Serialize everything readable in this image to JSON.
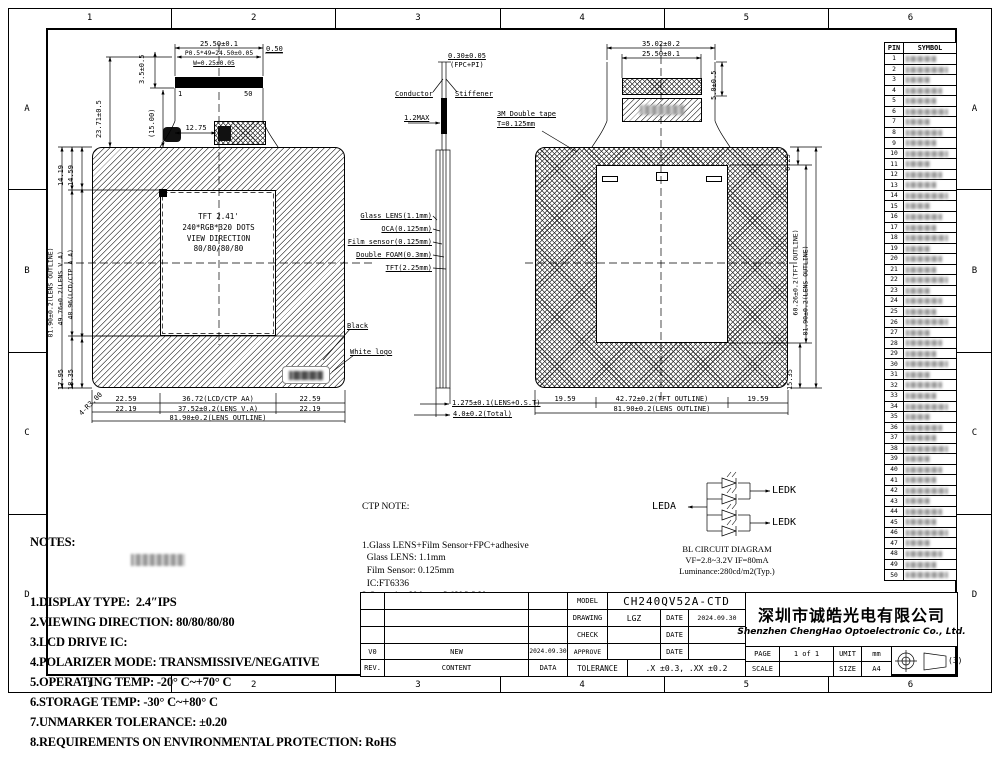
{
  "frame": {
    "cols": [
      "1",
      "2",
      "3",
      "4",
      "5",
      "6"
    ],
    "rows": [
      "A",
      "B",
      "C",
      "D"
    ]
  },
  "front_view": {
    "center_lines": [
      "TFT 2.41'",
      "240*RGB*320 DOTS",
      "VIEW DIRECTION",
      "80/80/80/80"
    ],
    "dims": {
      "top_width": "25.50±0.1",
      "pitch": "P0.5*49=24.50±0.05",
      "pad_width": "W=0.25±0.05",
      "end_offset": "0.50",
      "pin_first": "1",
      "pin_last": "50",
      "fpc_h1": "3.5±0.5",
      "fpc_h2": "(15.00)",
      "fpc_h3": "23.71±0.5",
      "fpc_x": "12.75",
      "left_outline": "81.90±0.2(LENS OUTLINE)",
      "left_va": "49.76±0.2(LENS V.A)",
      "left_aa": "48.96(LCD/CTP A.A)",
      "top_left_1": "14.19",
      "top_left_2": "14.59",
      "bot_left_1": "17.95",
      "bot_left_2": "18.35",
      "corner_r": "4-R3.00",
      "bottom_row1_l": "22.59",
      "bottom_row1_c": "36.72(LCD/CTP AA)",
      "bottom_row1_r": "22.59",
      "bottom_row2_l": "22.19",
      "bottom_row2_c": "37.52±0.2(LENS V.A)",
      "bottom_row2_r": "22.19",
      "bottom_row3": "81.90±0.2(LENS OUTLINE)"
    },
    "callouts": {
      "black": "Black",
      "white_logo": "White logo"
    }
  },
  "side_view": {
    "top_dim": "0.30±0.05",
    "top_dim_sub": "(FPC+PI)",
    "conductor": "Conductor",
    "stiffener": "Stiffener",
    "max_thick": "1.2MAX",
    "layers": [
      "Glass LENS(1.1mm)",
      "OCA(0.125mm)",
      "Film sensor(0.125mm)",
      "Double FOAM(0.3mm)",
      "TFT(2.25mm)"
    ],
    "tape_note1": "3M Double tape",
    "tape_note2": "T=0.125mm",
    "bottom_dim1": "1.275±0.1(LENS+O.S.T)",
    "bottom_dim2": "4.0±0.2(Total)"
  },
  "rear_view": {
    "dims": {
      "top1": "35.02±0.2",
      "top2": "25.50±0.1",
      "fpc_h": "5.0±0.5",
      "right_top": "6.25",
      "right_tft": "60.26±0.2(TFT OUTLINE)",
      "right_lens": "81.90±0.2(LENS OUTLINE)",
      "right_bot": "15.35",
      "bottom_l": "19.59",
      "bottom_c": "42.72±0.2(TFT OUTLINE)",
      "bottom_r": "19.59",
      "bottom_outline": "81.90±0.2(LENS OUTLINE)"
    }
  },
  "pin_table": {
    "headers": [
      "PIN",
      "SYMBOL"
    ],
    "pins": [
      "1",
      "2",
      "3",
      "4",
      "5",
      "6",
      "7",
      "8",
      "9",
      "10",
      "11",
      "12",
      "13",
      "14",
      "15",
      "16",
      "17",
      "18",
      "19",
      "20",
      "21",
      "22",
      "23",
      "24",
      "25",
      "26",
      "27",
      "28",
      "29",
      "30",
      "31",
      "32",
      "33",
      "34",
      "35",
      "36",
      "37",
      "38",
      "39",
      "40",
      "41",
      "42",
      "43",
      "44",
      "45",
      "46",
      "47",
      "48",
      "49",
      "50"
    ]
  },
  "notes": {
    "title": "NOTES:",
    "items": [
      "1.DISPLAY TYPE:  2.4″IPS",
      "2.VIEWING DIRECTION: 80/80/80/80",
      "3.LCD DRIVE IC:",
      "4.POLARIZER MODE: TRANSMISSIVE/NEGATIVE",
      "5.OPERATING TEMP: -20° C~+70° C",
      "6.STORAGE TEMP: -30° C~+80° C",
      "7.UNMARKER TOLERANCE: ±0.20",
      "8.REQUIREMENTS ON ENVIRONMENTAL PROTECTION: RoHS"
    ]
  },
  "ctp_note": {
    "title": "CTP NOTE:",
    "lines": [
      "1.Glass LENS+Film Sensor+FPC+adhesive",
      "  Glass LENS: 1.1mm",
      "  Film Sensor: 0.125mm",
      "  IC:FT6336",
      "2.Operation Voltage: 3.0V-3.3 V",
      "3.Transmittance: ≥87%",
      "4.The cover hardness: 6H"
    ]
  },
  "bl_circuit": {
    "leda": "LEDA",
    "ledk1": "LEDK",
    "ledk2": "LEDK",
    "title": "BL CIRCUIT DIAGRAM",
    "spec": "VF=2.8~3.2V  IF=80mA",
    "luminance": "Luminance:280cd/m2(Typ.)"
  },
  "title_block": {
    "model_label": "MODEL",
    "model": "CH240QV52A-CTD",
    "drawing_label": "DRAWING",
    "drawing": "LGZ",
    "date_label": "DATE",
    "drawing_date": "2024.09.30",
    "check_label": "CHECK",
    "approve_label": "APPROVE",
    "tolerance_label": "TOLERANCE",
    "tolerance": ".X ±0.3, .XX ±0.2",
    "rev0": "V0",
    "rev0_content": "NEW",
    "rev0_date": "2024.09.30",
    "rev_label": "REV.",
    "content_label": "CONTENT",
    "data_label": "DATA",
    "company_cn": "深圳市诚皓光电有限公司",
    "company_en": "Shenzhen ChengHao Optoelectronic Co., Ltd.",
    "page_label": "PAGE",
    "page": "1 of 1",
    "umit_label": "UMIT",
    "umit": "mm",
    "scale_label": "SCALE",
    "size_label": "SIZE",
    "size": "A4",
    "projection_note": "(3)"
  }
}
